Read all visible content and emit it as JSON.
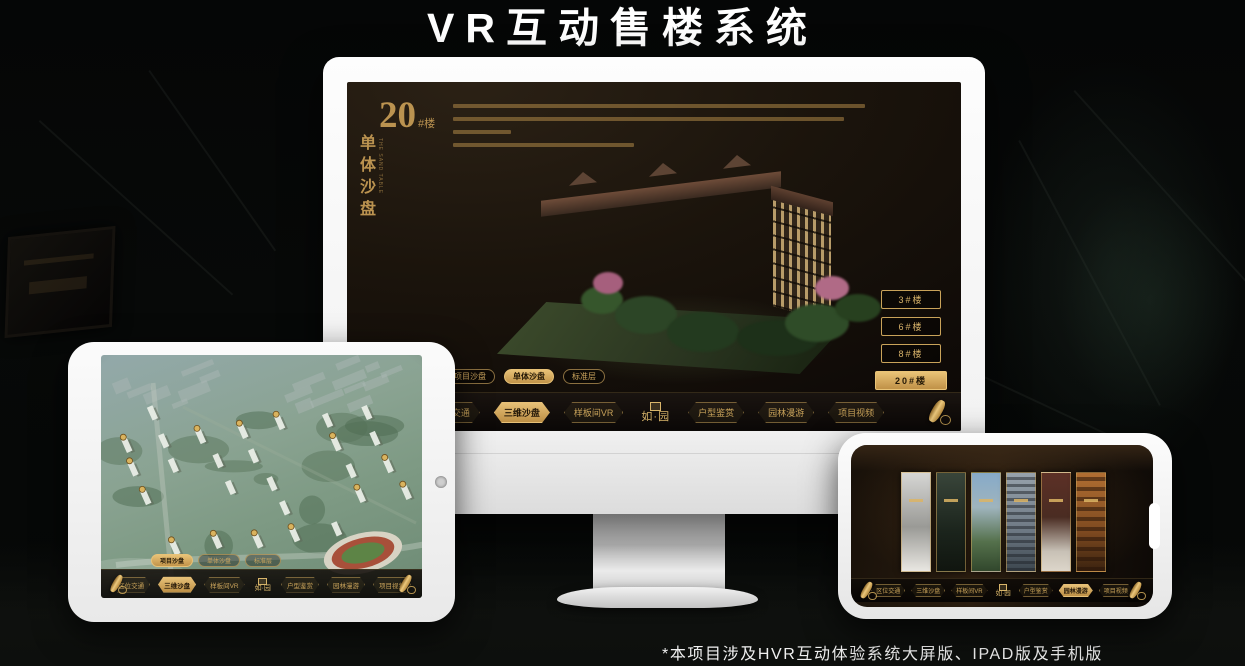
{
  "page": {
    "title": "VR互动售楼系统",
    "footnote": "*本项目涉及HVR互动体验系统大屏版、IPAD版及手机版"
  },
  "colors": {
    "gold": "#C9A35A",
    "gold_bright": "#E6C077",
    "screen_brown": "#1B140C",
    "device_white": "#F4F4F4"
  },
  "monitor": {
    "heading": {
      "number": "20",
      "suffix": "#楼",
      "vertical": "单体沙盘",
      "vertical_en": "THE SAND TABLE"
    },
    "floor_buttons": [
      {
        "label": "3#楼",
        "active": false
      },
      {
        "label": "6#楼",
        "active": false
      },
      {
        "label": "8#楼",
        "active": false
      },
      {
        "label": "20#楼",
        "active": true
      }
    ],
    "tabs": [
      {
        "label": "项目沙盘",
        "active": false
      },
      {
        "label": "单体沙盘",
        "active": true
      },
      {
        "label": "标准层",
        "active": false
      }
    ],
    "nav": {
      "scrolls": "right",
      "logo": "如·园",
      "items": [
        {
          "label": "区位交通",
          "active": false
        },
        {
          "label": "三维沙盘",
          "active": true
        },
        {
          "label": "样板间VR",
          "active": false
        },
        {
          "label": "户型鉴赏",
          "active": false
        },
        {
          "label": "园林漫游",
          "active": false
        },
        {
          "label": "项目视频",
          "active": false
        }
      ]
    }
  },
  "tablet": {
    "tabs": [
      {
        "label": "项目沙盘",
        "active": true
      },
      {
        "label": "单体沙盘",
        "active": false
      },
      {
        "label": "标准层",
        "active": false
      }
    ],
    "nav": {
      "scrolls": "both",
      "logo": "如·园",
      "items": [
        {
          "label": "区位交通",
          "active": false
        },
        {
          "label": "三维沙盘",
          "active": true
        },
        {
          "label": "样板间VR",
          "active": false
        },
        {
          "label": "户型鉴赏",
          "active": false
        },
        {
          "label": "园林漫游",
          "active": false
        },
        {
          "label": "项目视频",
          "active": false
        }
      ]
    }
  },
  "phone": {
    "gallery_panels": [
      {
        "name": "sketch-scene"
      },
      {
        "name": "dark-interior-scene"
      },
      {
        "name": "courtyard-scene"
      },
      {
        "name": "building-scene"
      },
      {
        "name": "autumn-scene"
      },
      {
        "name": "shelf-interior-scene"
      }
    ],
    "nav": {
      "scrolls": "both",
      "logo": "如·园",
      "items": [
        {
          "label": "区位交通",
          "active": false
        },
        {
          "label": "三维沙盘",
          "active": false
        },
        {
          "label": "样板间VR",
          "active": false
        },
        {
          "label": "户型鉴赏",
          "active": false
        },
        {
          "label": "园林漫游",
          "active": true
        },
        {
          "label": "项目视频",
          "active": false
        }
      ]
    }
  }
}
